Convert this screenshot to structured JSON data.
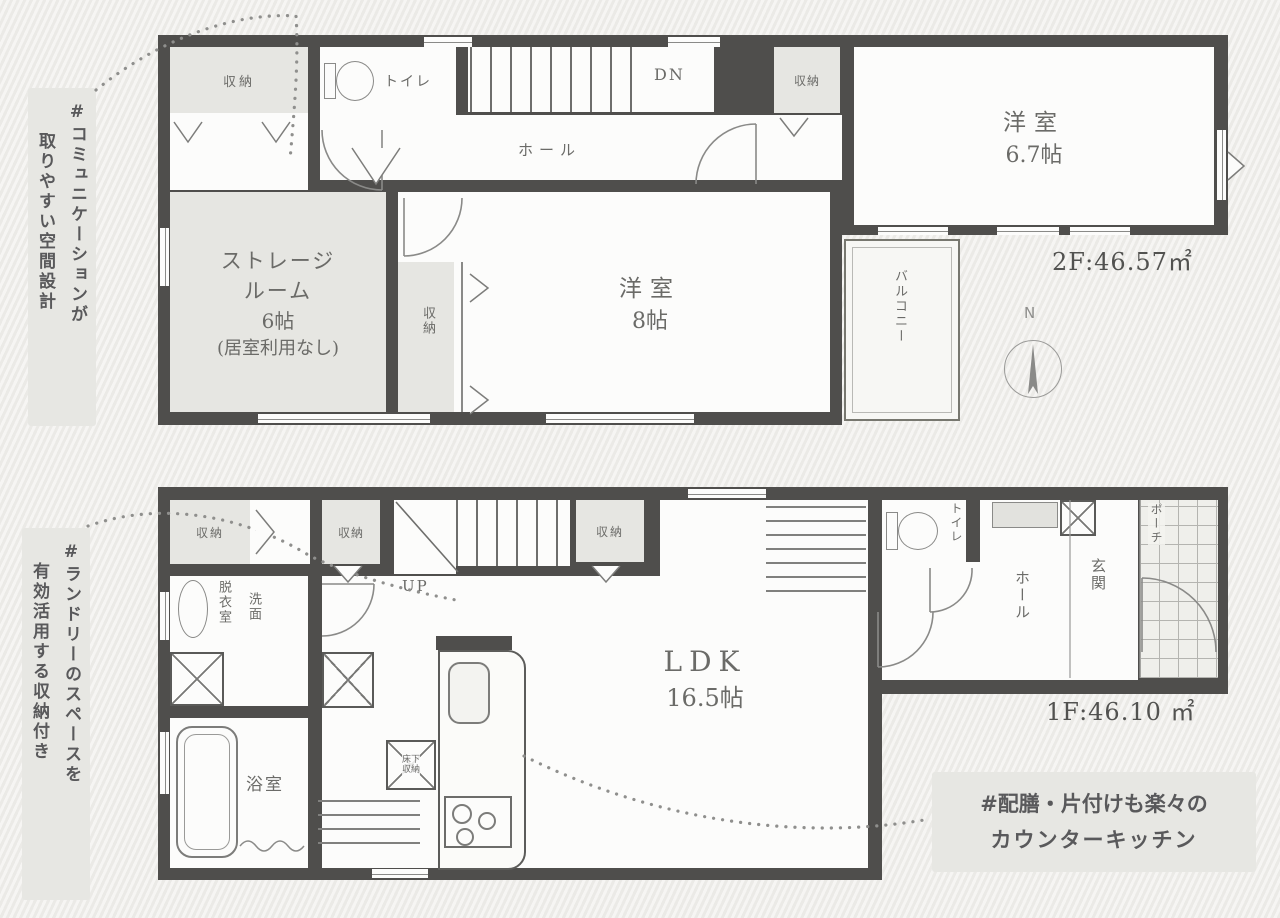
{
  "canvas": {
    "background": "#f1f0ed",
    "wall_color": "#4f4e4c"
  },
  "floor2": {
    "area_label": "2F:46.57㎡",
    "compass": "N",
    "labels": {
      "closet_top_left": "収納",
      "toilet": "トイレ",
      "stairs_down": "DN",
      "hall": "ホール",
      "closet_hall": "収納",
      "west_room_67_name": "洋室",
      "west_room_67_size": "6.7帖",
      "storage_room_l1": "ストレージ",
      "storage_room_l2": "ルーム",
      "storage_room_l3": "6帖",
      "storage_room_l4": "(居室利用なし)",
      "closet_vertical": "収納",
      "west_room_8_name": "洋室",
      "west_room_8_size": "8帖",
      "balcony": "バルコニー"
    }
  },
  "floor1": {
    "area_label": "1F:46.10 ㎡",
    "labels": {
      "closet_a": "収納",
      "closet_b": "収納",
      "closet_c": "収納",
      "stairs_up": "UP",
      "dressing_room": "脱衣室",
      "washroom": "洗面",
      "bathroom": "浴室",
      "ldk_name": "LDK",
      "ldk_size": "16.5帖",
      "underfloor_l1": "床下",
      "underfloor_l2": "収納",
      "toilet": "トイレ",
      "hall": "ホール",
      "entrance": "玄関",
      "porch": "ポーチ"
    }
  },
  "annotations": {
    "communication_l1": "#コミュニケーションが",
    "communication_l2": "取りやすい空間設計",
    "laundry_l1": "#ランドリーのスペースを",
    "laundry_l2": "有効活用する収納付き",
    "counter_kitchen_l1": "#配膳・片付けも楽々の",
    "counter_kitchen_l2": "カウンターキッチン"
  }
}
